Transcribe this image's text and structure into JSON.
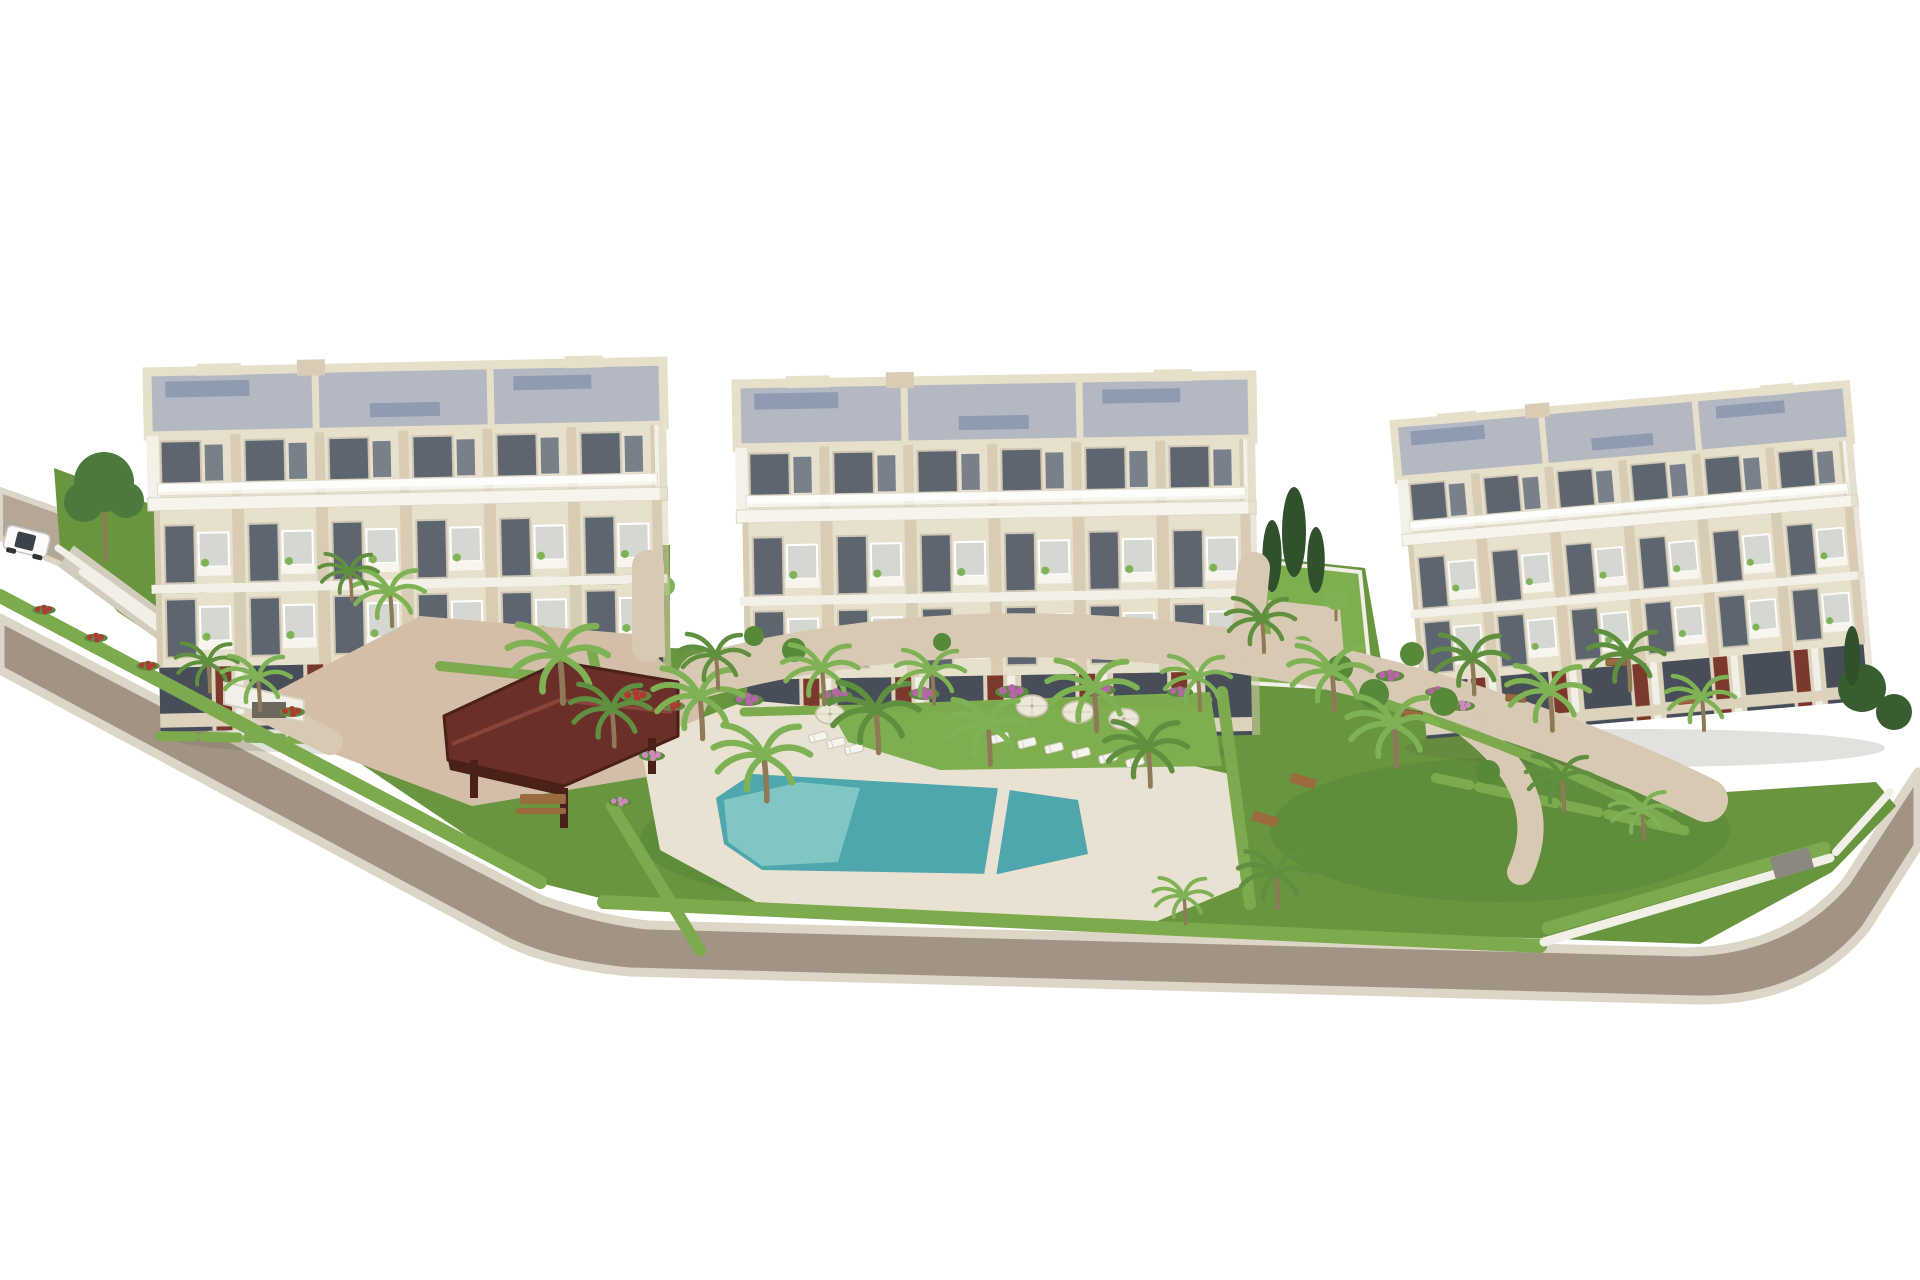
{
  "scene": {
    "type": "architectural-aerial-3d-render",
    "description": "Aerial 3D visualization of a new-build residential complex: three cream 4-storey apartment buildings with roof terraces, landscaped communal garden with swimming pool, wooden pergola, palm trees, hedges, flower beds, sun loungers and parasols, ring road with entrance gate and one white car",
    "text_content": [],
    "objects": {
      "apartment_buildings": 3,
      "floors_per_building": 4,
      "swimming_pool": 1,
      "pergola": 1,
      "entry_gate_canopy": 1,
      "garage_ramps": 2,
      "car": 1,
      "sun_umbrellas": 4,
      "sun_loungers": 9,
      "benches": 4,
      "palm_trees": 27,
      "cypress_trees": 4,
      "deciduous_tree": 1
    }
  },
  "colors": {
    "bg": "#ffffff",
    "road": "#a29485",
    "road2": "#b4a798",
    "curb": "#ddd5c6",
    "rampFill": "#d3cbbc",
    "lawn": "#69953f",
    "lawnLight": "#7fae4e",
    "lawnDark": "#4c7a33",
    "hedge": "#7caa4d",
    "palm": "#7fb254",
    "palmDark": "#5f8f3f",
    "treeTop": "#4c7a3c",
    "treeDark": "#3a5c31",
    "cypress": "#31502c",
    "bush": "#568a3a",
    "wall": "#e7e0cd",
    "wallDark": "#d8cdb4",
    "parapet": "#e6dfca",
    "roof": "#b4b8c2",
    "roofDark": "#8795ad",
    "glass": "#5d6571",
    "glassDark": "#474e59",
    "glassLight": "#78808c",
    "frame": "#cfc7b4",
    "maroon": "#7b382c",
    "pool": "#4fa6ad",
    "poolLight": "#90d2cc",
    "deck": "#e9e2d2",
    "path": "#d7c9b3",
    "plaza": "#d3bfa9",
    "pergola": "#6b2f2a",
    "pergolaDark": "#4a2019",
    "pergolaHi": "#8a453a",
    "trunk": "#8f7a58",
    "bench": "#9a6b3f",
    "flowerMag": "#b666a8",
    "flowerPink": "#cf8abd",
    "flowerRed": "#ae3a31",
    "wallWhite": "#f2efe7",
    "carBody": "#fbfbfb"
  }
}
